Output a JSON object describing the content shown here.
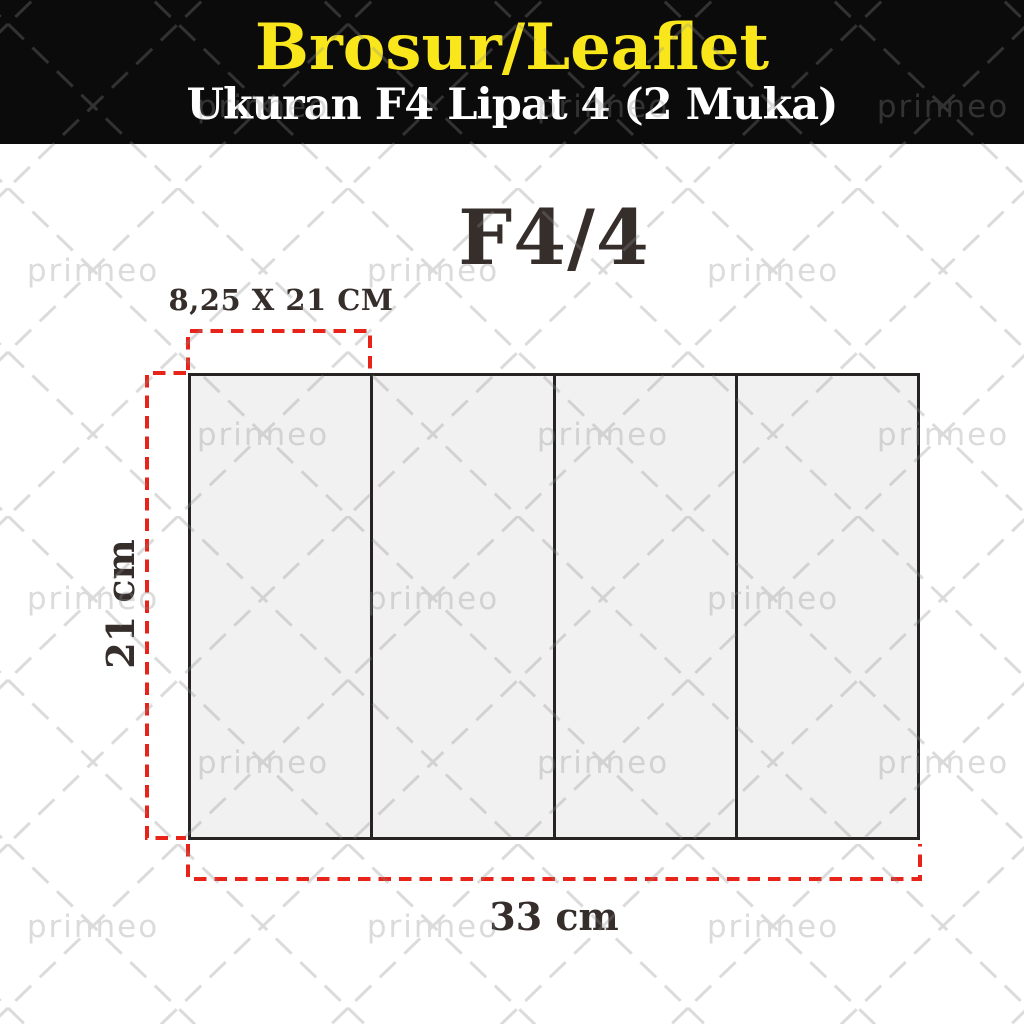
{
  "theme": {
    "header_bg": "#0b0b0b",
    "title_yellow": "#f9e71c",
    "subtitle_white": "#ffffff",
    "text_ink": "#362e2b",
    "dashed_red": "#e8231a",
    "panel_fill": "#f2f1f1",
    "line_dark": "#262322",
    "watermark_gray": "#8c8c8c"
  },
  "header": {
    "title": "Brosur/Leaflet",
    "subtitle": "Ukuran F4 Lipat 4 (2 Muka)"
  },
  "diagram": {
    "format_label": "F4/4",
    "panel_size_label": "8,25 X 21 CM",
    "height_label": "21 cm",
    "width_label": "33 cm",
    "panel_count": 4
  },
  "watermark": {
    "text": "prinneo"
  }
}
